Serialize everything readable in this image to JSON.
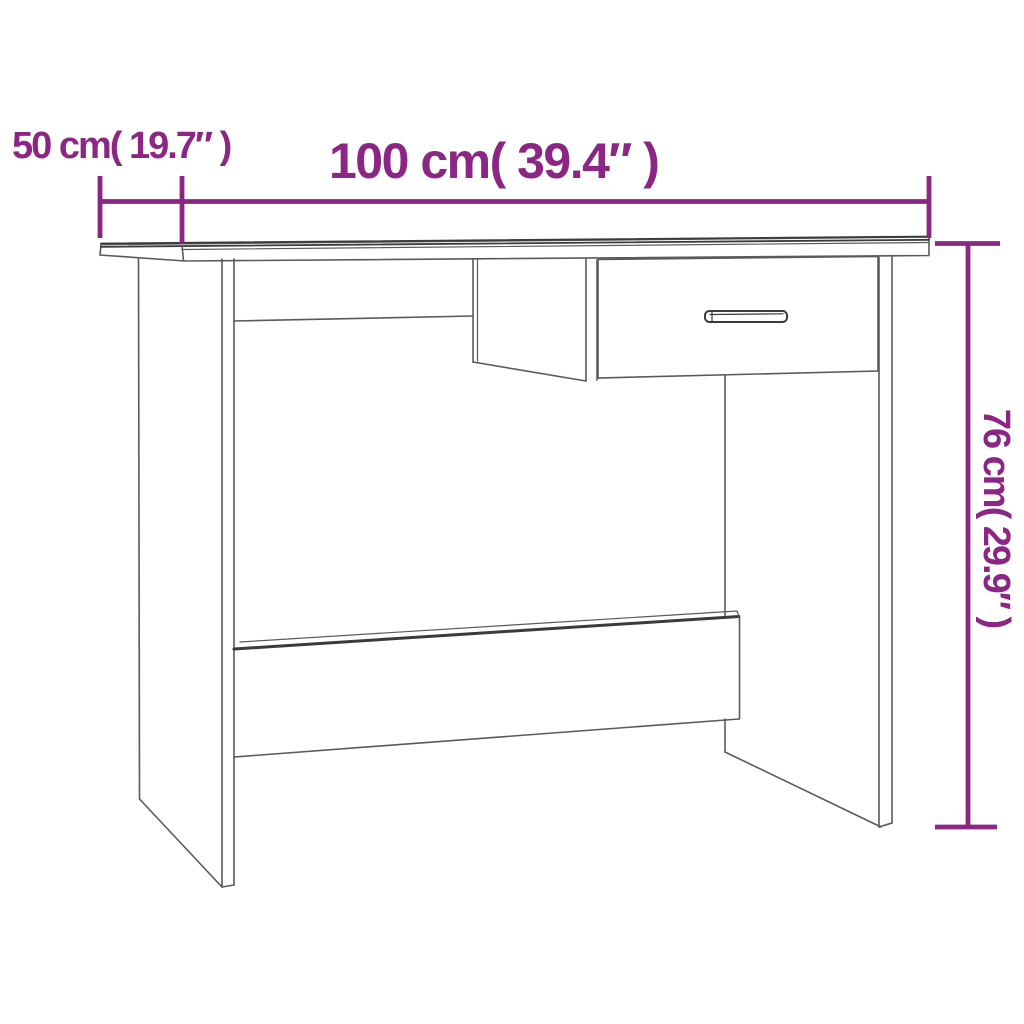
{
  "diagram": {
    "type": "furniture-dimension-diagram",
    "subject": "desk-with-drawer",
    "background_color": "#ffffff",
    "accent_color": "#8C2684",
    "line_color": "#5a5a5c",
    "dark_line_color": "#3b3b3d",
    "labels": {
      "width": "100 cm( 39.4″ )",
      "depth": "50 cm( 19.7″ )",
      "height": "76 cm( 29.9″ )"
    },
    "values": {
      "width_cm": 100,
      "width_in": 39.4,
      "depth_cm": 50,
      "depth_in": 19.7,
      "height_cm": 76,
      "height_in": 29.9
    }
  }
}
